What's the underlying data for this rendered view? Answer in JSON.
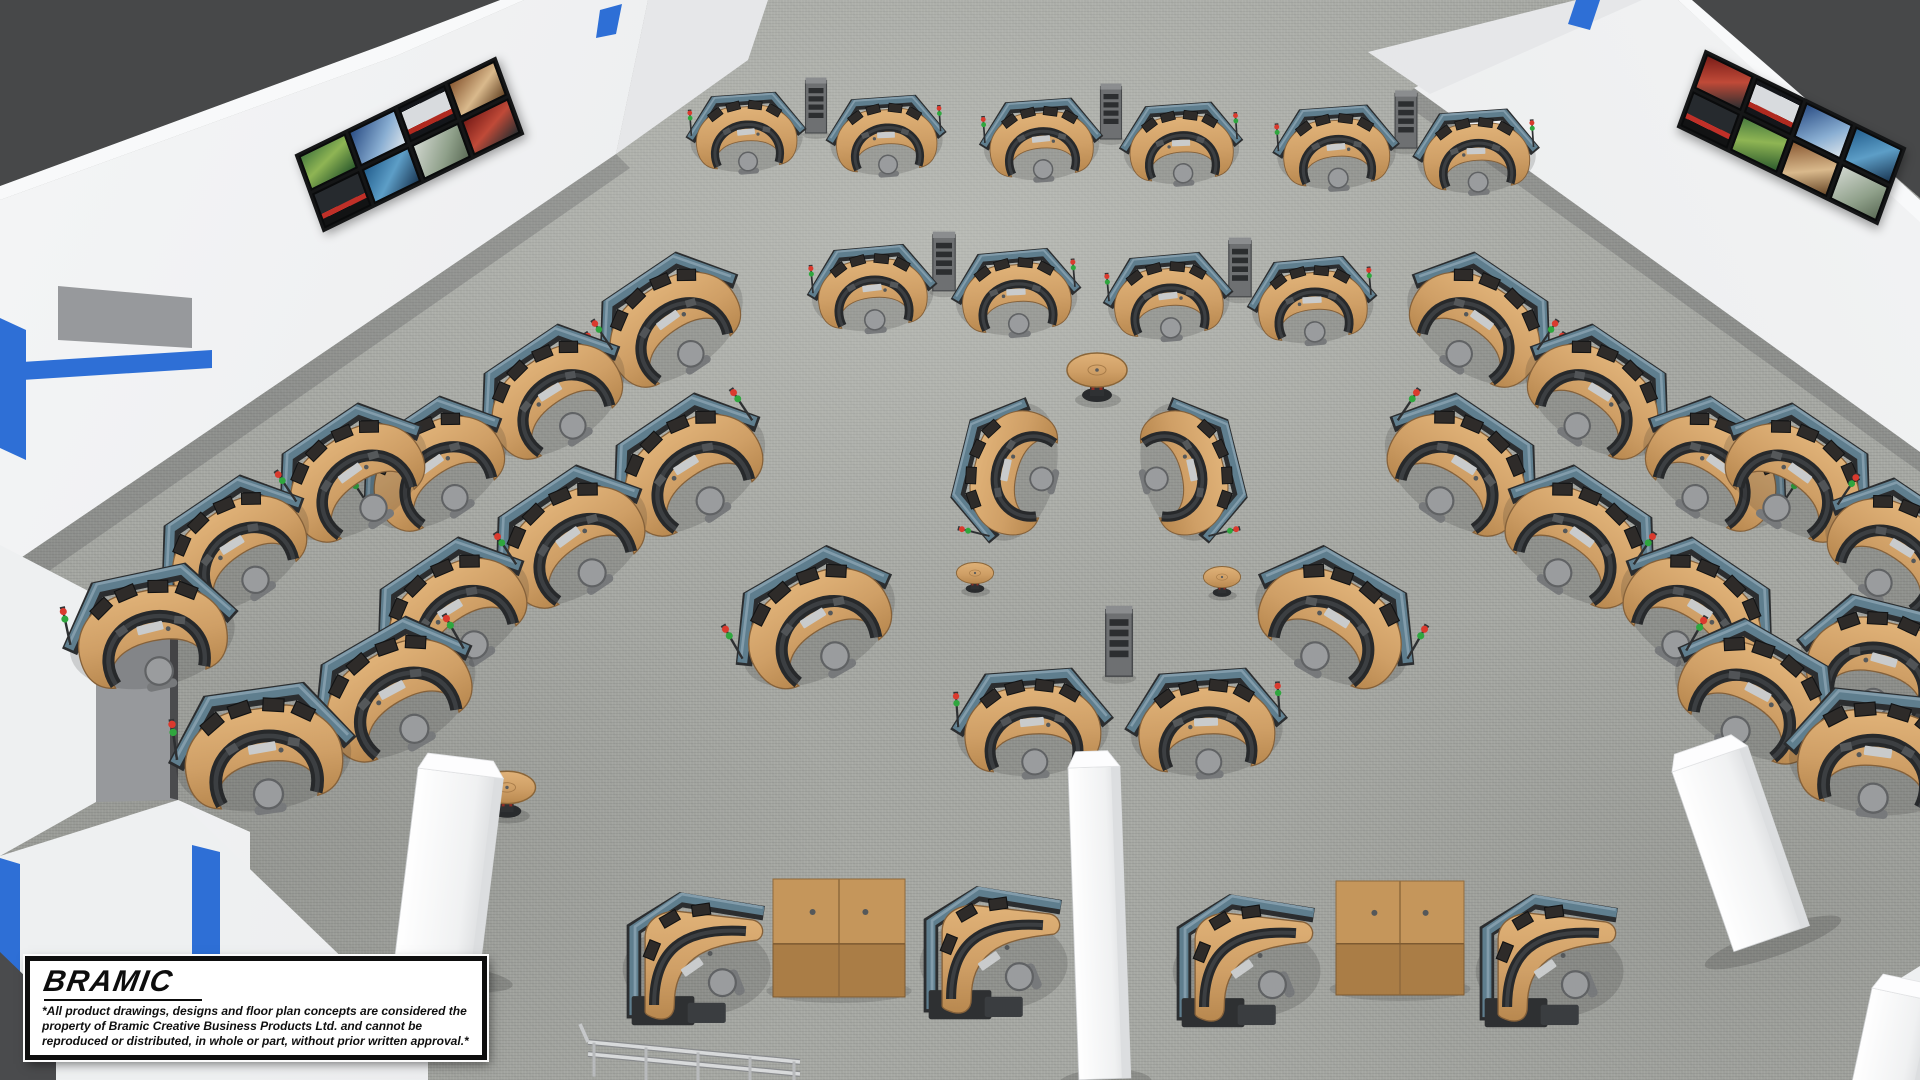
{
  "watermark": {
    "logo": "BRAMIC",
    "disclaimer": "*All product drawings, designs and floor plan concepts are considered the property of Bramic Creative Business Products Ltd. and cannot be reproduced or distributed, in whole or part, without prior written approval.*"
  },
  "scene": {
    "title": "Control room floor plan concept - 3D rendering",
    "workstation_count": 42,
    "colors": {
      "floor": "#a6a8a3",
      "ceiling": "#474849",
      "wall": "#eef0f1",
      "accent_blue": "#2e6fd6",
      "desk_wood": "#cf9f66",
      "privacy_panel": "#5f7e8e",
      "console": "#2b2d2f",
      "chair": "#9a9c9e",
      "status_red": "#da3a2e",
      "status_green": "#2fa63e",
      "pillar": "#f6f7f8",
      "cabinet_wood": "#c5965b"
    },
    "video_walls": [
      {
        "id": "left",
        "x": 298,
        "y": 103,
        "rot": -20,
        "skew": -6,
        "rows": 2,
        "cols": 4,
        "screens": [
          "linear-gradient(160deg,#4a7c3f,#8fb554 45%,#2e5c2e)",
          "linear-gradient(135deg,#2c4f86,#89aed2 60%,#d8e2ea)",
          "linear-gradient(#14161a 0 12%,#d8dbde 12% 68%,#b02a20 68% 84%,#14161a 84%)",
          "linear-gradient(150deg,#8a5a34,#d9b98c 55%,#6b4a2a)",
          "linear-gradient(#262a2e 0 62%,#c03028 62% 78%,#121314 78%)",
          "linear-gradient(140deg,#24608f,#5d9ec7 50%,#1c3a57)",
          "linear-gradient(130deg,#cfd5cd,#8fa08a 60%,#5d6d58)",
          "linear-gradient(155deg,#7a1d18,#c04a38 50%,#2c2e30)"
        ]
      },
      {
        "id": "right",
        "x": 1680,
        "y": 96,
        "rot": 20,
        "skew": 6,
        "rows": 2,
        "cols": 4,
        "screens": [
          "linear-gradient(155deg,#7a1d18,#c04a38 50%,#2c2e30)",
          "linear-gradient(#14161a 0 12%,#d8dbde 12% 68%,#b02a20 68% 84%,#14161a 84%)",
          "linear-gradient(135deg,#2c4f86,#89aed2 60%,#d8e2ea)",
          "linear-gradient(140deg,#24608f,#5d9ec7 50%,#1c3a57)",
          "linear-gradient(#262a2e 0 62%,#c03028 62% 78%,#121314 78%)",
          "linear-gradient(160deg,#4a7c3f,#8fb554 45%,#2e5c2e)",
          "linear-gradient(150deg,#8a5a34,#d9b98c 55%,#6b4a2a)",
          "linear-gradient(130deg,#cfd5cd,#8fa08a 60%,#5d6d58)"
        ]
      }
    ],
    "pods": [
      {
        "x": 746,
        "y": 132,
        "rot": -4,
        "s": 0.74,
        "flip": false
      },
      {
        "x": 886,
        "y": 135,
        "rot": -4,
        "s": 0.74,
        "flip": true
      },
      {
        "x": 1041,
        "y": 139,
        "rot": -4,
        "s": 0.76,
        "flip": false
      },
      {
        "x": 1181,
        "y": 143,
        "rot": -4,
        "s": 0.76,
        "flip": true
      },
      {
        "x": 1336,
        "y": 147,
        "rot": -4,
        "s": 0.78,
        "flip": false
      },
      {
        "x": 1476,
        "y": 151,
        "rot": -4,
        "s": 0.78,
        "flip": true
      },
      {
        "x": 872,
        "y": 288,
        "rot": -5,
        "s": 0.8,
        "flip": false
      },
      {
        "x": 1016,
        "y": 292,
        "rot": -5,
        "s": 0.8,
        "flip": true
      },
      {
        "x": 1168,
        "y": 296,
        "rot": -5,
        "s": 0.8,
        "flip": false
      },
      {
        "x": 1312,
        "y": 300,
        "rot": -5,
        "s": 0.8,
        "flip": true
      },
      {
        "x": 668,
        "y": 320,
        "rot": -34,
        "s": 1.02,
        "flip": false
      },
      {
        "x": 550,
        "y": 392,
        "rot": -34,
        "s": 1.02,
        "flip": true
      },
      {
        "x": 432,
        "y": 464,
        "rot": -34,
        "s": 1.02,
        "flip": false
      },
      {
        "x": 686,
        "y": 465,
        "rot": -34,
        "s": 1.08,
        "flip": true
      },
      {
        "x": 568,
        "y": 537,
        "rot": -34,
        "s": 1.08,
        "flip": false
      },
      {
        "x": 450,
        "y": 609,
        "rot": -34,
        "s": 1.08,
        "flip": true
      },
      {
        "x": 350,
        "y": 473,
        "rot": -34,
        "s": 1.05,
        "flip": false
      },
      {
        "x": 232,
        "y": 545,
        "rot": -34,
        "s": 1.05,
        "flip": true
      },
      {
        "x": 150,
        "y": 628,
        "rot": -12,
        "s": 1.1,
        "flip": false
      },
      {
        "x": 262,
        "y": 748,
        "rot": -8,
        "s": 1.16,
        "flip": false
      },
      {
        "x": 392,
        "y": 690,
        "rot": -30,
        "s": 1.12,
        "flip": true
      },
      {
        "x": 813,
        "y": 618,
        "rot": -30,
        "s": 1.1,
        "flip": false
      },
      {
        "x": 1482,
        "y": 320,
        "rot": 34,
        "s": 1.02,
        "flip": true
      },
      {
        "x": 1600,
        "y": 392,
        "rot": 34,
        "s": 1.02,
        "flip": false
      },
      {
        "x": 1718,
        "y": 464,
        "rot": 34,
        "s": 1.02,
        "flip": true
      },
      {
        "x": 1464,
        "y": 465,
        "rot": 34,
        "s": 1.08,
        "flip": false
      },
      {
        "x": 1582,
        "y": 537,
        "rot": 34,
        "s": 1.08,
        "flip": true
      },
      {
        "x": 1700,
        "y": 609,
        "rot": 34,
        "s": 1.08,
        "flip": false
      },
      {
        "x": 1800,
        "y": 473,
        "rot": 34,
        "s": 1.05,
        "flip": true
      },
      {
        "x": 1902,
        "y": 548,
        "rot": 34,
        "s": 1.05,
        "flip": false
      },
      {
        "x": 1884,
        "y": 660,
        "rot": 14,
        "s": 1.1,
        "flip": true
      },
      {
        "x": 1878,
        "y": 752,
        "rot": 6,
        "s": 1.16,
        "flip": true
      },
      {
        "x": 1758,
        "y": 692,
        "rot": 30,
        "s": 1.12,
        "flip": false
      },
      {
        "x": 1337,
        "y": 618,
        "rot": 30,
        "s": 1.1,
        "flip": true
      },
      {
        "x": 1006,
        "y": 470,
        "rot": -76,
        "s": 0.92,
        "flip": false
      },
      {
        "x": 1192,
        "y": 470,
        "rot": 76,
        "s": 0.92,
        "flip": true
      },
      {
        "x": 1032,
        "y": 722,
        "rot": -4,
        "s": 1.0,
        "flip": false
      },
      {
        "x": 1206,
        "y": 722,
        "rot": -4,
        "s": 1.0,
        "flip": true
      }
    ],
    "corner_desks": [
      {
        "x": 700,
        "y": 958,
        "s": 1.12
      },
      {
        "x": 997,
        "y": 952,
        "s": 1.12
      },
      {
        "x": 1250,
        "y": 960,
        "s": 1.12
      },
      {
        "x": 1553,
        "y": 960,
        "s": 1.12
      }
    ],
    "racks": [
      {
        "x": 816,
        "y": 106,
        "s": 0.75
      },
      {
        "x": 1111,
        "y": 112,
        "s": 0.75
      },
      {
        "x": 1406,
        "y": 120,
        "s": 0.78
      },
      {
        "x": 944,
        "y": 262,
        "s": 0.8
      },
      {
        "x": 1240,
        "y": 268,
        "s": 0.8
      },
      {
        "x": 1119,
        "y": 642,
        "s": 0.95
      }
    ],
    "round_tables": [
      {
        "x": 1097,
        "y": 378,
        "s": 1.0
      },
      {
        "x": 507,
        "y": 795,
        "s": 0.95
      },
      {
        "x": 1727,
        "y": 812,
        "s": 0.95
      },
      {
        "x": 975,
        "y": 578,
        "s": 0.62
      },
      {
        "x": 1222,
        "y": 582,
        "s": 0.62
      }
    ],
    "cabinets": [
      {
        "x": 839,
        "y": 938,
        "w": 132,
        "h": 118
      },
      {
        "x": 1400,
        "y": 938,
        "w": 128,
        "h": 114
      }
    ],
    "pillars": [
      {
        "x": 418,
        "y": 768,
        "w": 86,
        "h": 200,
        "rot": 7
      },
      {
        "x": 1672,
        "y": 772,
        "w": 80,
        "h": 190,
        "rot": -19
      },
      {
        "x": 1068,
        "y": 768,
        "w": 52,
        "h": 312,
        "rot": -2
      },
      {
        "x": 1872,
        "y": 988,
        "w": 70,
        "h": 110,
        "rot": 12
      }
    ],
    "railing": {
      "x": 588,
      "y": 1028
    }
  }
}
